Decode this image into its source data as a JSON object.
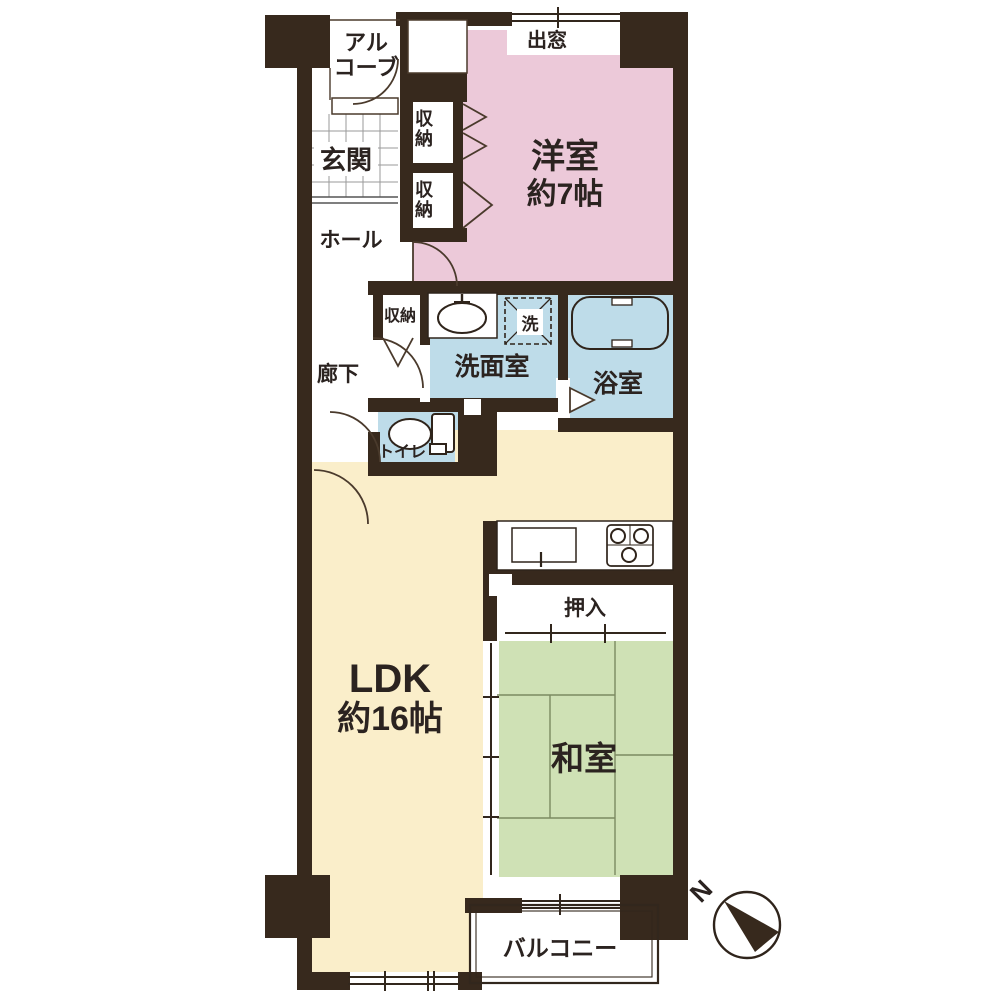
{
  "plan": {
    "alcove_line1": "アル",
    "alcove_line2": "コーブ",
    "bay_window": "出窓",
    "western_room": {
      "name": "洋室",
      "size": "約7帖"
    },
    "entrance": "玄関",
    "closet_upper": "収納",
    "closet_lower": "収納",
    "hall": "ホール",
    "corridor_storage": "収納",
    "corridor": "廊下",
    "washroom": "洗面室",
    "laundry": "洗",
    "bathroom": "浴室",
    "toilet": "トイレ",
    "ldk": {
      "name": "LDK",
      "size": "約16帖"
    },
    "oshiire": "押入",
    "japanese_room": "和室",
    "balcony": "バルコニー",
    "compass_north": "N"
  },
  "colors": {
    "wall": "#37291d",
    "western_room": "#ecc9d9",
    "ldk": "#faeeca",
    "japanese_room": "#cfe1b5",
    "water": "#bedce9",
    "white": "#ffffff"
  }
}
